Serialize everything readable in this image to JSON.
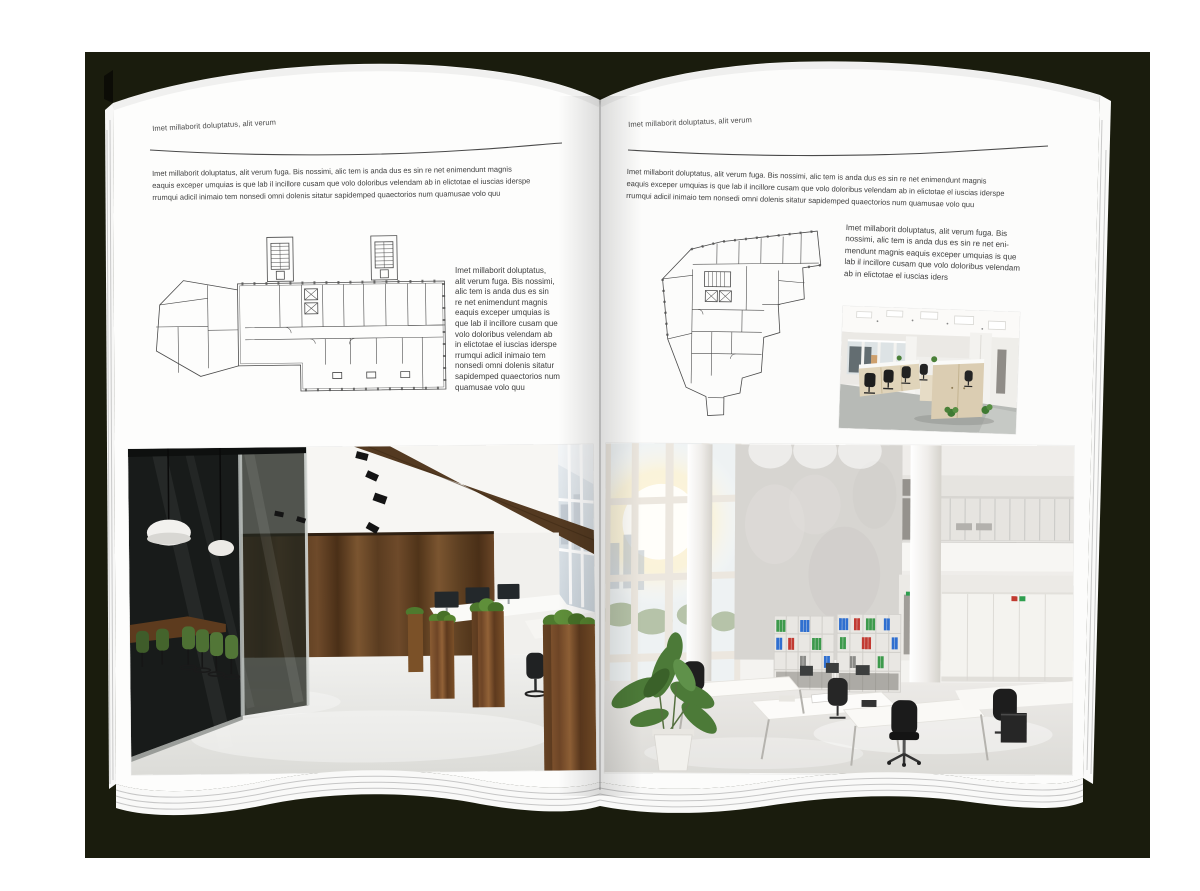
{
  "document": {
    "type_label": "magazine-spread-mockup",
    "colors": {
      "backdrop": "#1a1c0d",
      "page": "#fdfdfc",
      "text": "#3e3e3e",
      "rule": "#4a4a4a",
      "wood": "#6b4627",
      "foliage": "#4e7a2e",
      "binder_green": "#3d9a4c",
      "binder_blue": "#2f6fd0",
      "binder_red": "#c23a32"
    }
  },
  "left_page": {
    "header": "Imet millaborit doluptatus, alit verum",
    "intro_lines": [
      "Imet millaborit doluptatus, alit verum fuga. Bis nossimi, alic tem is anda dus es sin re net enimendunt magnis",
      "eaquis exceper umquias is que lab il incillore cusam que volo doloribus velendam ab in elictotae el iuscias iderspe",
      "rrumqui adicil inimaio tem nonsedi omni dolenis sitatur sapidemped quaectorios num quamusae volo quu"
    ],
    "side_lines": [
      "Imet millaborit doluptatus,",
      "alit verum fuga. Bis nossimi,",
      "alic tem is anda dus es sin",
      "re net enimendunt magnis",
      "eaquis exceper umquias is",
      "que lab il incillore cusam que",
      "volo doloribus velendam ab",
      "in elictotae el iuscias iderspe",
      "rrumqui adicil inimaio tem",
      "nonsedi omni dolenis sitatur",
      "sapidemped quaectorios num",
      "quamusae volo quu"
    ]
  },
  "right_page": {
    "header": "Imet millaborit doluptatus, alit verum",
    "intro_lines": [
      "Imet millaborit doluptatus, alit verum fuga. Bis nossimi, alic tem is anda dus es sin re net enimendunt magnis",
      "eaquis exceper umquias is que lab il incillore cusam que volo doloribus velendam ab in elictotae el iuscias iderspe",
      "rrumqui adicil inimaio tem nonsedi omni dolenis sitatur sapidemped quaectorios num quamusae volo quu"
    ],
    "side_lines": [
      "Imet millaborit doluptatus, alit verum fuga. Bis",
      "nossimi, alic tem is anda dus es sin re net eni-",
      "mendunt magnis eaquis exceper umquias is que",
      "lab il incillore cusam que volo doloribus velendam",
      "ab in elictotae el iuscias iders"
    ]
  }
}
